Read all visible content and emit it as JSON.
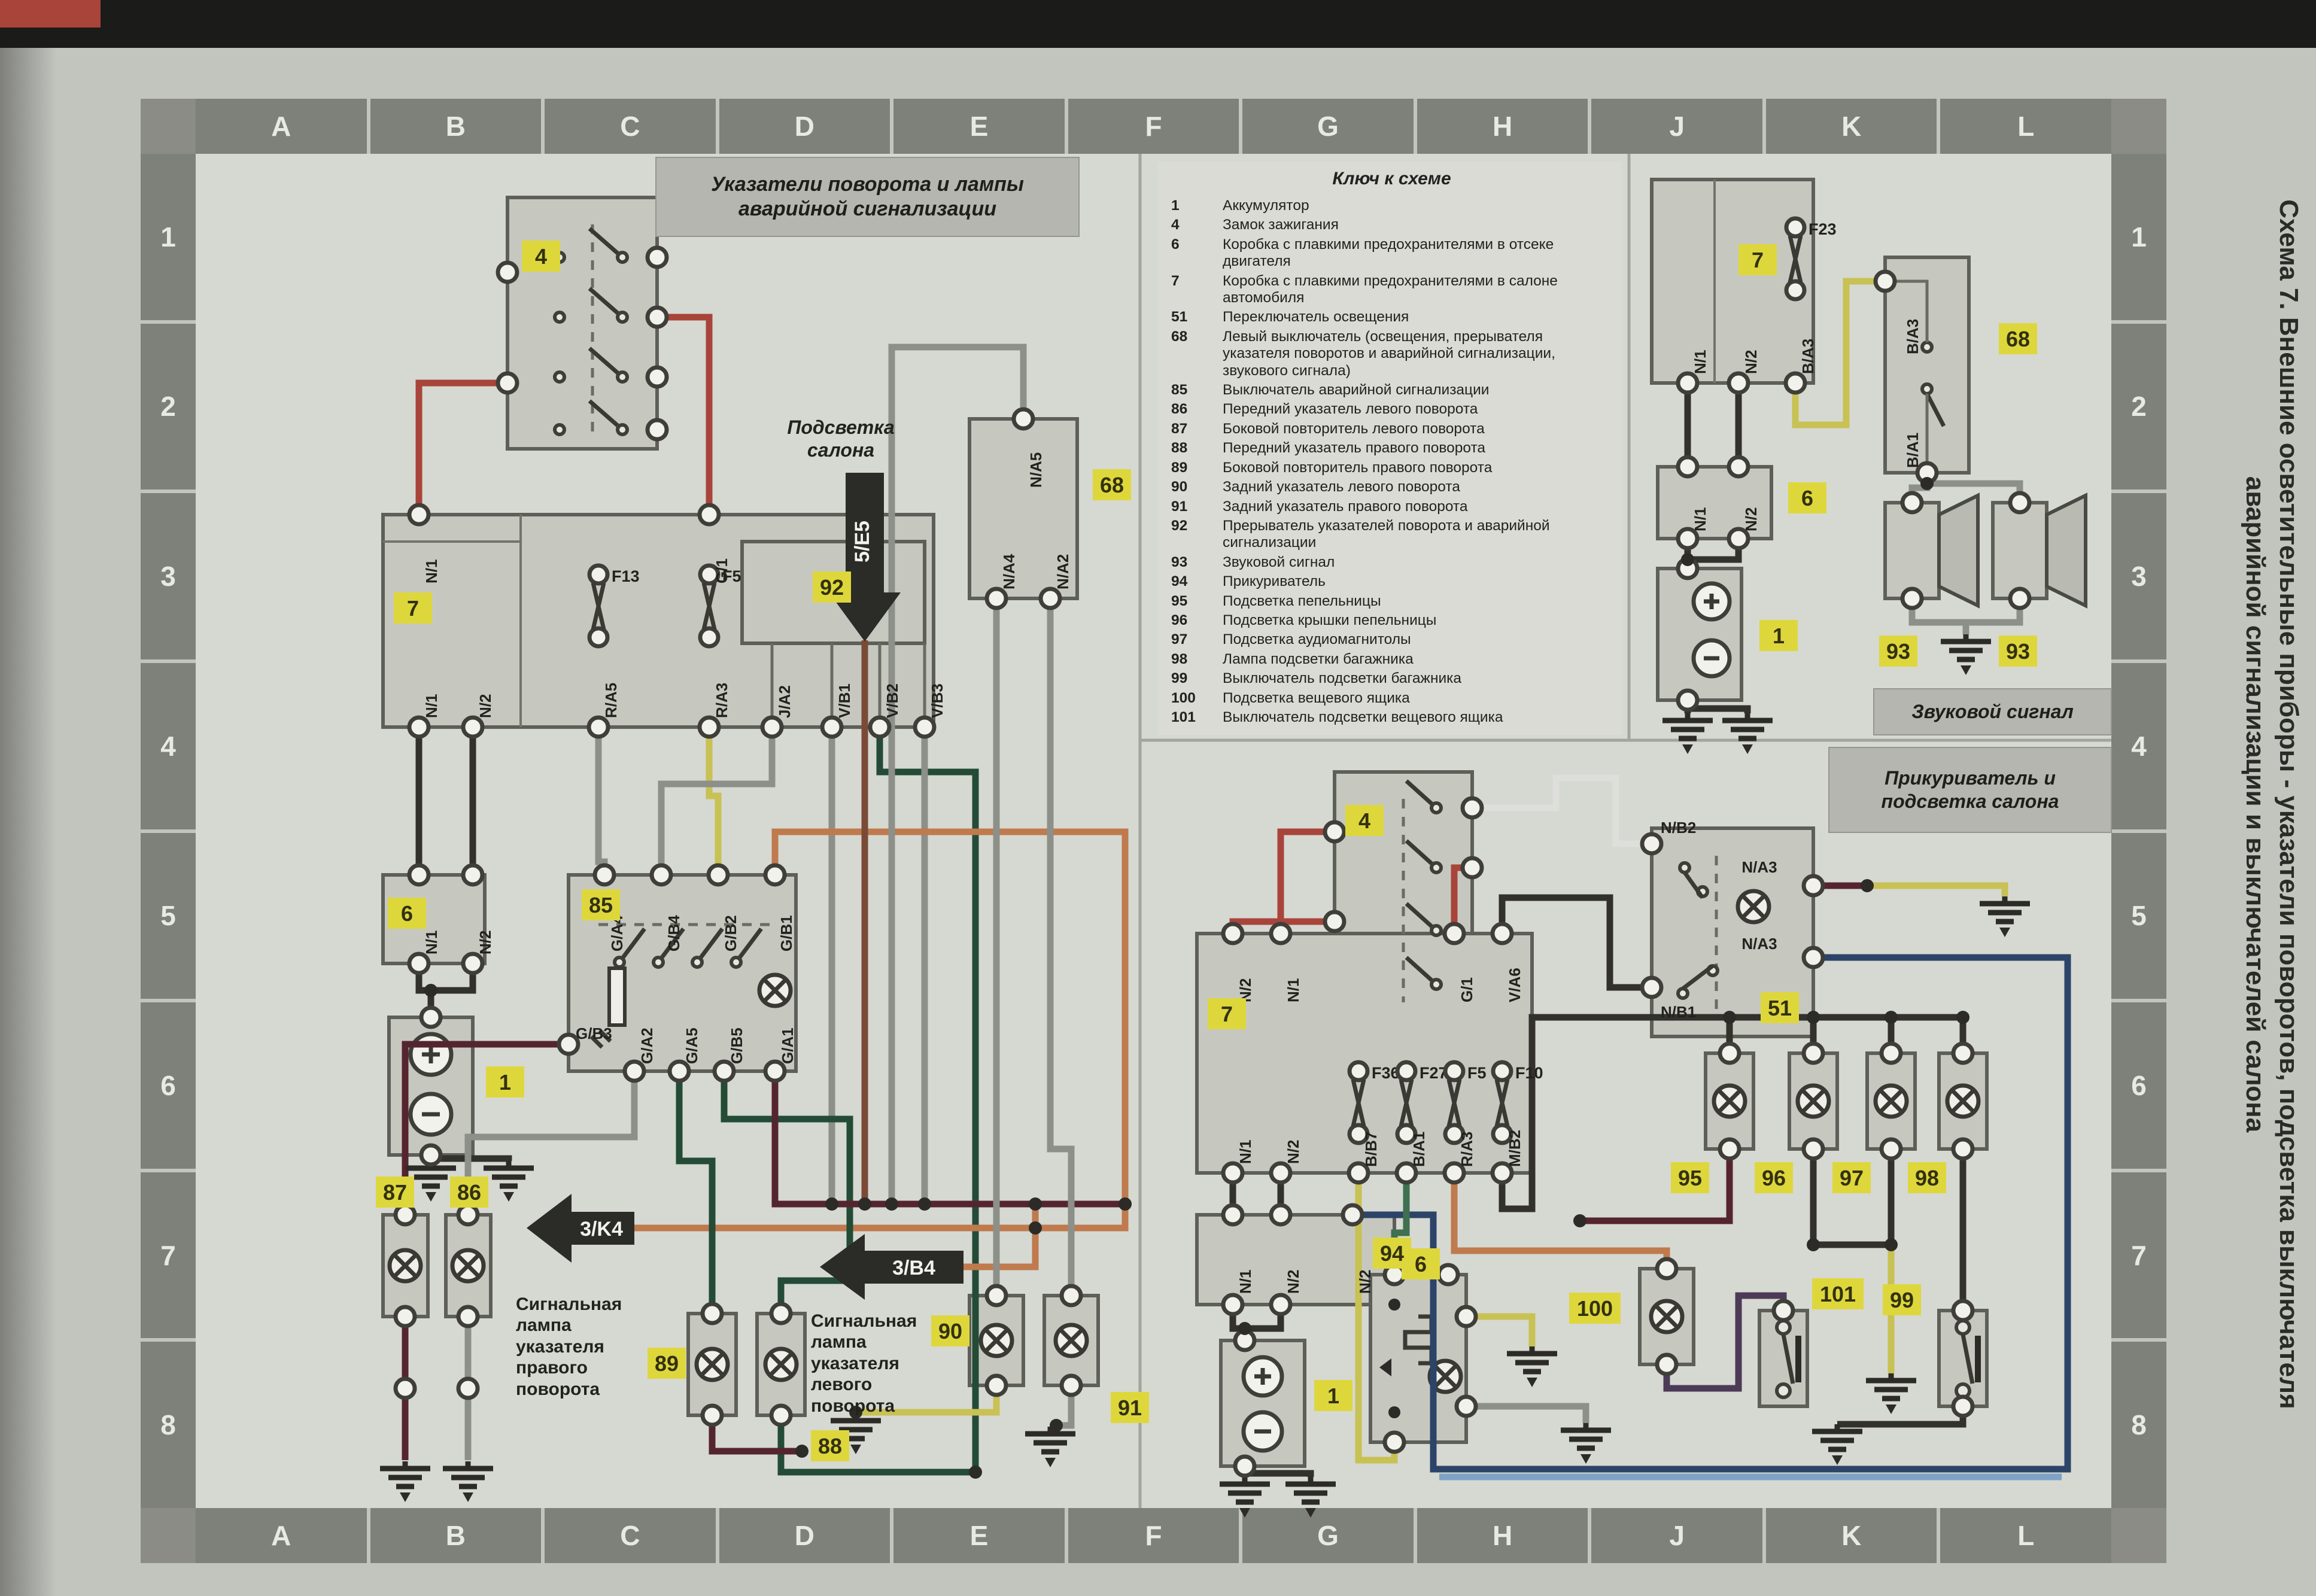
{
  "palette": {
    "red": "#a8443a",
    "maroon": "#55252f",
    "brown": "#7b4a36",
    "orange": "#bf7a4d",
    "yellow": "#c8c154",
    "green": "#3f7050",
    "dkgreen": "#234b36",
    "gray": "#8d8f89",
    "dark": "#32312c",
    "navy": "#2c4468",
    "ltblue": "#7da3c6",
    "purple": "#4d3a57",
    "whitewire": "#dededa",
    "tag": "#ded73c"
  },
  "page": {
    "scheme_title_line1": "Схема 7. Внешние осветительные приборы - указатели поворотов, подсветка выключателя",
    "scheme_title_line2": "аварийной сигнализации и выключателей салона"
  },
  "grid": {
    "letters": [
      "A",
      "B",
      "C",
      "D",
      "E",
      "F",
      "G",
      "H",
      "J",
      "K",
      "L"
    ],
    "numbers": [
      "1",
      "2",
      "3",
      "4",
      "5",
      "6",
      "7",
      "8"
    ]
  },
  "titles": {
    "left": "Указатели поворота и лампы аварийной сигнализации",
    "horn": "Звуковой сигнал",
    "lighter": "Прикуриватель и подсветка салона",
    "cabin": "Подсветка салона"
  },
  "annotations": {
    "right_lamp": "Сигнальная лампа указателя правого поворота",
    "left_lamp": "Сигнальная лампа указателя левого поворота"
  },
  "arrows": {
    "cabin": "5/E5",
    "right": "3/K4",
    "left": "3/B4"
  },
  "legend": {
    "title": "Ключ к схеме",
    "items": [
      {
        "num": "1",
        "text": "Аккумулятор"
      },
      {
        "num": "4",
        "text": "Замок зажигания"
      },
      {
        "num": "6",
        "text": "Коробка с плавкими предохранителями в отсеке двигателя"
      },
      {
        "num": "7",
        "text": "Коробка с плавкими предохранителями в салоне автомобиля"
      },
      {
        "num": "51",
        "text": "Переключатель освещения"
      },
      {
        "num": "68",
        "text": "Левый выключатель (освещения, прерывателя указателя поворотов и аварийной сигнализации, звукового сигнала)"
      },
      {
        "num": "85",
        "text": "Выключатель аварийной сигнализации"
      },
      {
        "num": "86",
        "text": "Передний указатель левого поворота"
      },
      {
        "num": "87",
        "text": "Боковой повторитель левого поворота"
      },
      {
        "num": "88",
        "text": "Передний указатель правого поворота"
      },
      {
        "num": "89",
        "text": "Боковой повторитель правого поворота"
      },
      {
        "num": "90",
        "text": "Задний указатель левого поворота"
      },
      {
        "num": "91",
        "text": "Задний указатель правого поворота"
      },
      {
        "num": "92",
        "text": "Прерыватель указателей поворота и аварийной сигнализации"
      },
      {
        "num": "93",
        "text": "Звуковой сигнал"
      },
      {
        "num": "94",
        "text": "Прикуриватель"
      },
      {
        "num": "95",
        "text": "Подсветка пепельницы"
      },
      {
        "num": "96",
        "text": "Подсветка крышки пепельницы"
      },
      {
        "num": "97",
        "text": "Подсветка аудиомагнитолы"
      },
      {
        "num": "98",
        "text": "Лампа подсветки багажника"
      },
      {
        "num": "99",
        "text": "Выключатель подсветки багажника"
      },
      {
        "num": "100",
        "text": "Подсветка вещевого ящика"
      },
      {
        "num": "101",
        "text": "Выключатель подсветки вещевого ящика"
      }
    ]
  },
  "tags": {
    "t1": "1",
    "t4": "4",
    "t6": "6",
    "t7": "7",
    "t51": "51",
    "t68": "68",
    "t85": "85",
    "t86": "86",
    "t87": "87",
    "t88": "88",
    "t89": "89",
    "t90": "90",
    "t91": "91",
    "t92": "92",
    "t93": "93",
    "t94": "94",
    "t95": "95",
    "t96": "96",
    "t97": "97",
    "t98": "98",
    "t99": "99",
    "t100": "100",
    "t101": "101"
  },
  "fuses": {
    "f13": "F13",
    "f5": "F5",
    "f23": "F23",
    "f36": "F36",
    "f27": "F27",
    "f5b": "F5",
    "f10": "F10"
  },
  "term": {
    "l7t1": "N/1",
    "l7t2": "G/1",
    "l7b1": "N/1",
    "l7b2": "N/2",
    "l7b3": "R/A5",
    "l7b4": "R/A3",
    "l92b1": "J/A2",
    "l92b2": "V/B1",
    "l92b3": "V/B2",
    "l92b4": "V/B3",
    "l6a": "N/1",
    "l6b": "N/2",
    "h85t1": "G/A4",
    "h85t2": "G/B4",
    "h85t3": "G/B2",
    "h85t4": "G/B1",
    "h85b1": "G/B3",
    "h85b2": "G/A2",
    "h85b3": "G/A5",
    "h85b4": "G/B5",
    "h85b5": "G/A1",
    "l68t": "N/A5",
    "l68b1": "N/A4",
    "l68b2": "N/A2",
    "r7a": "N/1",
    "r7b": "N/2",
    "r7c": "B/A3",
    "r68a": "B/A3",
    "r68b": "B/A1",
    "r6a": "N/1",
    "r6b": "N/2",
    "q7t1": "N/2",
    "q7t2": "N/1",
    "q7t3": "G/1",
    "q7t4": "V/A6",
    "q7b1": "N/1",
    "q7b2": "N/2",
    "qf1": "B/B7",
    "qf2": "B/A1",
    "qf3": "R/A3",
    "qf4": "M/B2",
    "q6a": "N/1",
    "q6b": "N/2",
    "q6c": "N/2",
    "s51a": "N/B2",
    "s51b": "N/B1",
    "s51c": "N/A3",
    "s51d": "N/A3"
  }
}
